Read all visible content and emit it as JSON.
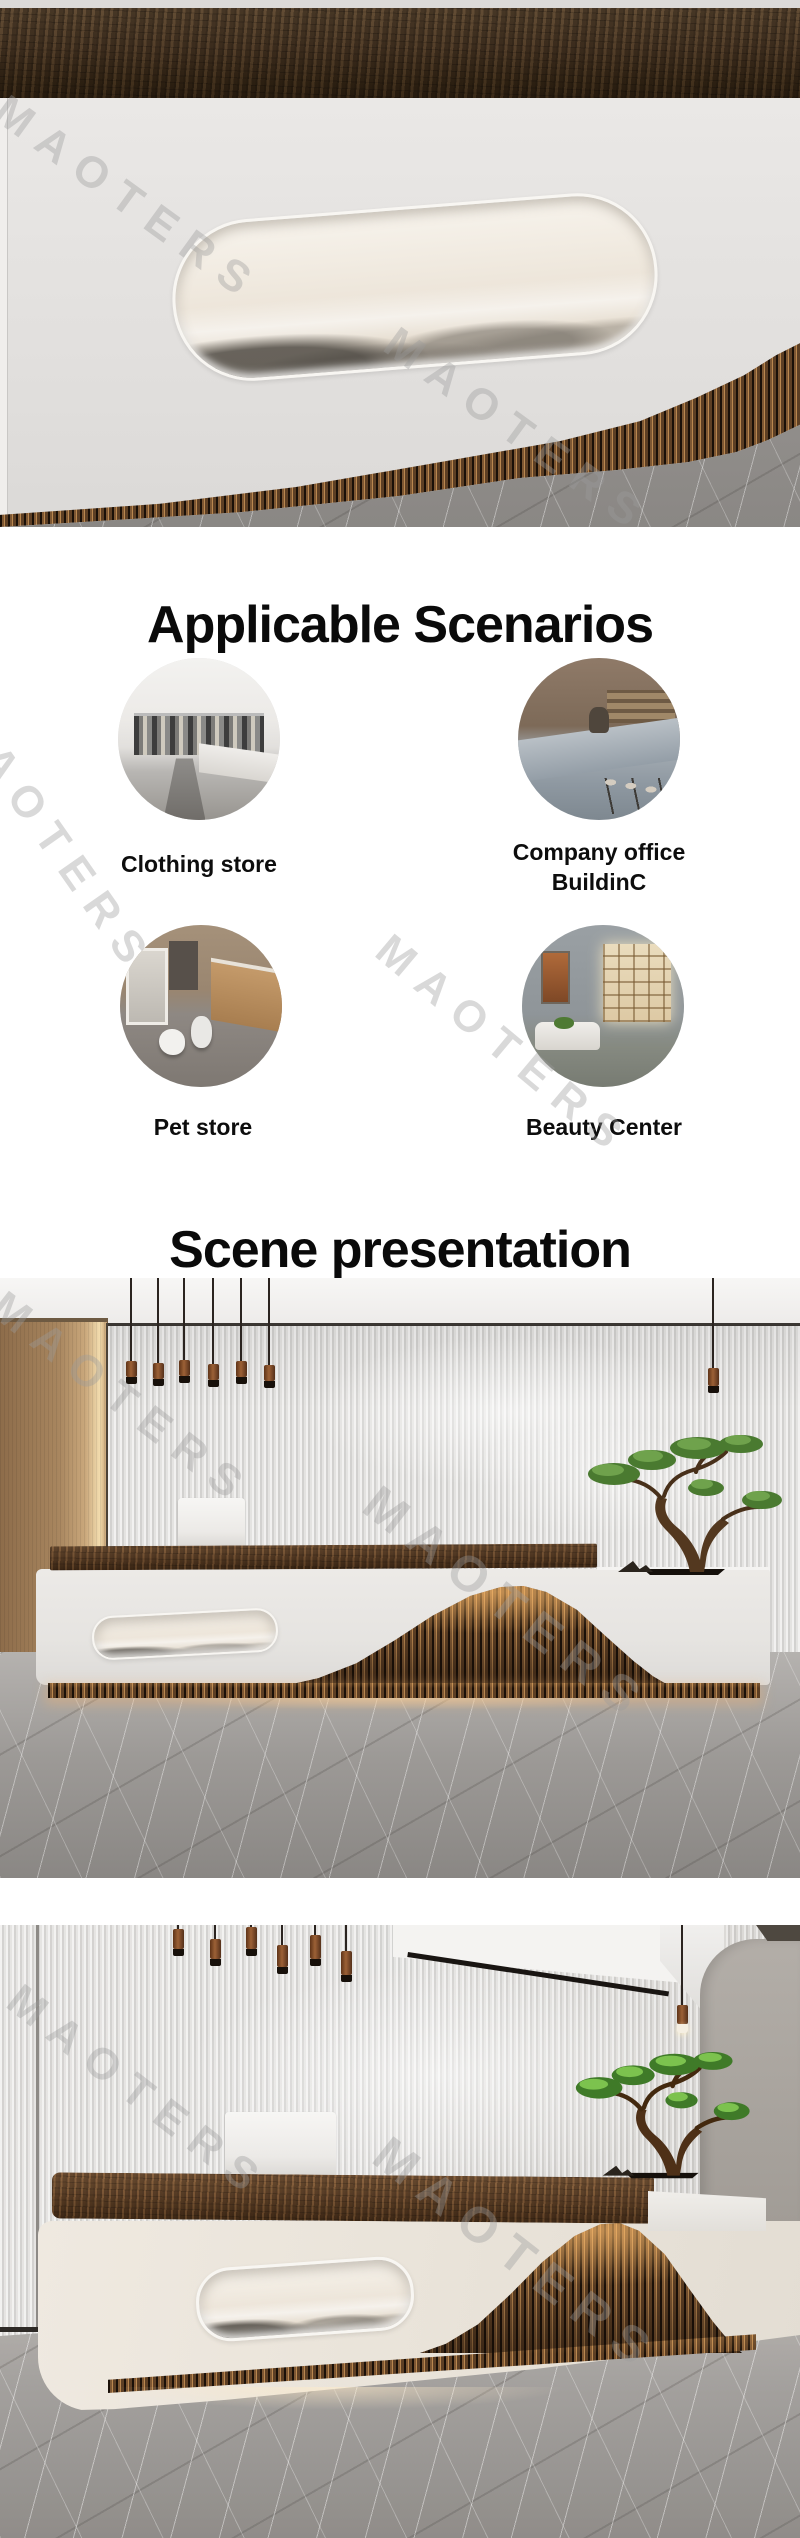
{
  "watermark": {
    "text": "MAOTERS",
    "color_hex": "#9c9c9c"
  },
  "sections": {
    "scenarios": {
      "title": "Applicable Scenarios",
      "items": [
        {
          "id": "clothing-store",
          "label": "Clothing store"
        },
        {
          "id": "company-office",
          "label": "Company office BuildinC"
        },
        {
          "id": "pet-store",
          "label": "Pet store"
        },
        {
          "id": "beauty-center",
          "label": "Beauty Center"
        }
      ]
    },
    "scene": {
      "title": "Scene presentation"
    }
  },
  "colors": {
    "text": "#0a0a0a",
    "watermark": "#9c9c9c",
    "wood_dark": "#3c2d1d",
    "wood_mid": "#6b4e33",
    "slat_light": "#b9874f",
    "slat_dark": "#1a1008",
    "warm_glow": "#f0a85e",
    "desk_white": "#e8e6e3",
    "desk_cream": "#eae4da",
    "marble_gray": "#a3a09d",
    "panel_tan": "#b08a5f",
    "flute_light": "#f2f1f0",
    "flute_dark": "#d2d1cf",
    "wall_gray": "#a9a49e"
  }
}
